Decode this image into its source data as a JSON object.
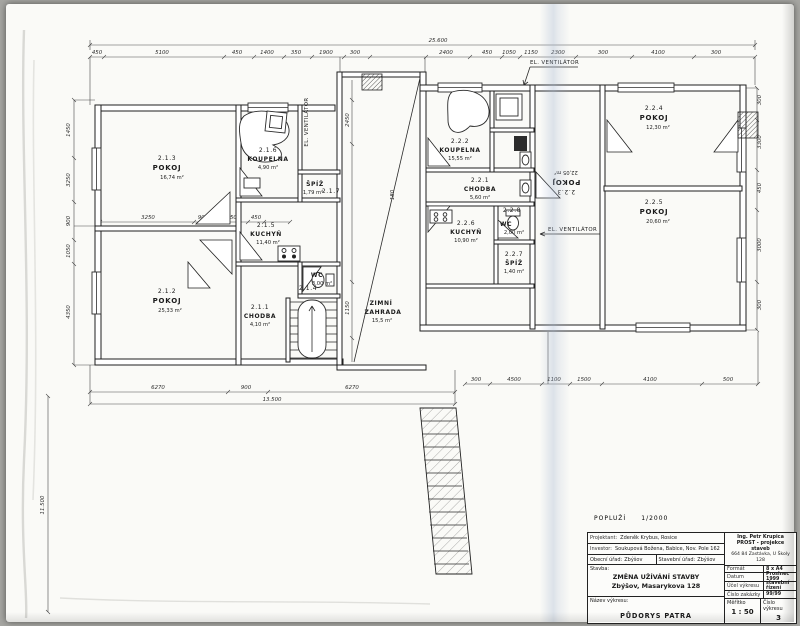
{
  "rooms": [
    {
      "id": "2.1.3",
      "name": "POKOJ",
      "area": "16,74 m²"
    },
    {
      "id": "2.1.6",
      "name": "KOUPELNA",
      "area": "4,90 m²"
    },
    {
      "id": "2.1.7",
      "name": "ŠPÍŽ",
      "area": "1,79 m²"
    },
    {
      "id": "2.1.5",
      "name": "KUCHYŇ",
      "area": "11,40 m²"
    },
    {
      "id": "2.1.4",
      "name": "WC",
      "area": "3,00 m²"
    },
    {
      "id": "2.1.1",
      "name": "CHODBA",
      "area": "4,10 m²"
    },
    {
      "id": "2.1.2",
      "name": "POKOJ",
      "area": "25,33 m²"
    },
    {
      "id": "",
      "name": "ZIMNÍ",
      "name_b": "ZAHRADA",
      "area": "15,5 m²"
    },
    {
      "id": "2.2.2",
      "name": "KOUPELNA",
      "area": "15,55 m²"
    },
    {
      "id": "2.2.1",
      "name": "CHODBA",
      "area": "5,60 m²"
    },
    {
      "id": "2.2.6",
      "name": "KUCHYŇ",
      "area": "10,90 m²"
    },
    {
      "id": "2.2.8",
      "name": "WC",
      "area": "2,00 m²"
    },
    {
      "id": "2.2.7",
      "name": "ŠPÍŽ",
      "area": "1,40 m²"
    },
    {
      "id": "2.2.3",
      "name": "POKOJ",
      "area": "22,05 m²"
    },
    {
      "id": "2.2.4",
      "name": "POKOJ",
      "area": "12,30 m²"
    },
    {
      "id": "2.2.5",
      "name": "POKOJ",
      "area": "20,60 m²"
    }
  ],
  "annotations": {
    "vent_top": "EL. VENTILÁTOR",
    "vent_mid": "EL. VENTILÁTOR",
    "vent_right": "EL. VENTILÁTOR",
    "note_left": "POPLUŽÍ",
    "note_scale": "1/2000"
  },
  "dims": {
    "total_top": "25.600",
    "total_bottom": "13.500",
    "total_left": "11.500",
    "top": [
      "450",
      "5100",
      "450",
      "1400",
      "350",
      "1900",
      "300",
      "2400",
      "450",
      "1050",
      "1150",
      "2300",
      "300",
      "4100",
      "300"
    ],
    "bottom": [
      "6270",
      "900",
      "6270"
    ],
    "bottom_right": [
      "300",
      "4500",
      "1100",
      "1500",
      "4100",
      "500"
    ],
    "left": [
      "1450",
      "3250",
      "900",
      "1050",
      "4350"
    ],
    "right": [
      "300",
      "3300",
      "450",
      "3000",
      "300"
    ],
    "inner": [
      "3250",
      "900",
      "1050",
      "450"
    ],
    "strip": [
      "2450",
      "1150",
      "180"
    ]
  },
  "titleblock": {
    "projektant_label": "Projektant:",
    "projektant": "Zdeněk Krybus, Rosice",
    "investor_label": "Investor:",
    "investor": "Soukupová Božena, Babice, Nov. Pole 162",
    "obecni_urad_label": "Obecní úřad:",
    "obecni_urad": "Zbýšov",
    "stavebni_urad_label": "Stavební úřad:",
    "stavebni_urad": "Zbýšov",
    "stavba_label": "Stavba:",
    "stavba_line1": "ZMĚNA UŽÍVÁNÍ STAVBY",
    "stavba_line2": "Zbýšov, Masarykova 128",
    "nazev_label": "Název výkresu:",
    "nazev": "PŮDORYS PATRA",
    "firm_line1": "Ing. Petr Krupica",
    "firm_line2": "PROST - projekce staveb",
    "firm_line3": "664 84 Zastávka, U Školy 128",
    "format_label": "Formát",
    "format": "8 x A4",
    "datum_label": "Datum",
    "datum": "Prosinec 1999",
    "ucel_label": "Účel výkresu",
    "ucel": "stavební řízení",
    "zakazka_label": "Číslo zakázky",
    "zakazka": "99/99",
    "meritko_label": "Měřítko",
    "meritko": "1 : 50",
    "cislo_label": "Číslo výkresu",
    "cislo": "3"
  }
}
